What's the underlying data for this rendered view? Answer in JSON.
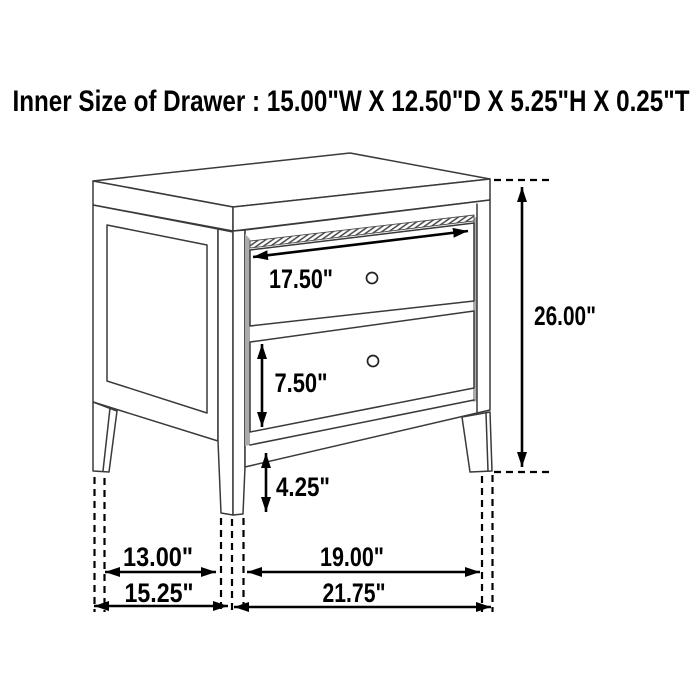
{
  "title": "Inner Size of Drawer : 15.00\"W X 12.50\"D X 5.25\"H X 0.25\"T",
  "annotations": {
    "top_drawer_width": "17.50\"",
    "bottom_drawer_height": "7.50\"",
    "leg_height": "4.25\"",
    "overall_height": "26.00\"",
    "side_inner_span": "13.00\"",
    "front_inner_span": "19.00\"",
    "overall_depth": "15.25\"",
    "overall_width": "21.75\""
  }
}
